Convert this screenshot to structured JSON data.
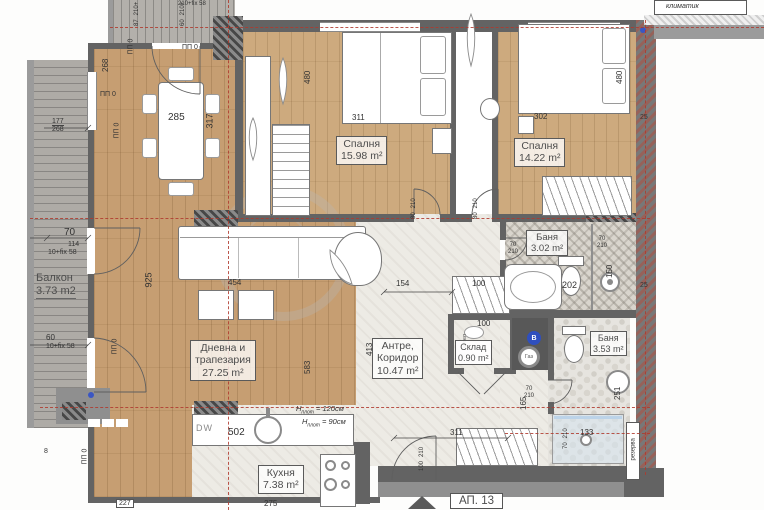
{
  "plan": {
    "apartment": "АП. 13",
    "ac_unit": "климатик",
    "reserve": "резерва",
    "boiler_tag": "котел"
  },
  "rooms": {
    "balcony": {
      "name": "Балкон",
      "area": "3.73 m2"
    },
    "living": {
      "line1": "Дневна и",
      "line2": "трапезария",
      "area": "27.25 m²"
    },
    "bedroom1": {
      "name": "Спалня",
      "area": "15.98 m²"
    },
    "bedroom2": {
      "name": "Спалня",
      "area": "14.22 m²"
    },
    "bath1": {
      "name": "Баня",
      "area": "3.02 m²"
    },
    "bath2": {
      "name": "Баня",
      "area": "3.53 m²"
    },
    "hall": {
      "line1": "Антре,",
      "line2": "Коридор",
      "area": "10.47 m²"
    },
    "storage": {
      "name": "Склад",
      "area": "0.90 m²"
    },
    "kitchen": {
      "name": "Кухня",
      "area": "7.38 m²"
    }
  },
  "dims": {
    "dining_width": "285",
    "dining_depth": "317",
    "balc_top_depth": "268",
    "frac_top": "177",
    "frac_bottom": "268",
    "left_win_70": "70",
    "left_win_114": "114",
    "left_fix_a": "10+fix 58",
    "left_win_60": "60",
    "left_fix_b": "10+fix 58",
    "left_door_8": "8",
    "living_height": "925",
    "sofa_span": "454",
    "living_span": "583",
    "hall_height": "413",
    "bed1_width": "311",
    "bed1_depth": "480",
    "bed2_width": "302",
    "bed2_depth": "480",
    "wall_25_a": "25",
    "wall_25_b": "25",
    "hall_width": "154",
    "ward_100": "100",
    "storage_100": "100",
    "bath1_202": "202",
    "bath1_150": "150",
    "hall_165": "165",
    "hall_311": "311",
    "sink_251": "251",
    "shower_133": "133",
    "sink_502": "502",
    "kitchen_275": "275",
    "kitchen_227": "227",
    "top_87": "87",
    "top_210p_a": "210+",
    "top_60": "60",
    "top_210p_b": "210+",
    "top_fix": "210+fix 58",
    "pp0": "ПП 0"
  },
  "doors": {
    "bed1": {
      "w": "80",
      "h": "210"
    },
    "bed2": {
      "w": "80",
      "h": "210"
    },
    "bath1": {
      "w": "70",
      "h": "210"
    },
    "bath1_shower": {
      "w": "70",
      "h": "210"
    },
    "bath2": {
      "w": "70",
      "h": "210"
    },
    "bath2_shower": {
      "w": "70",
      "h": "210"
    },
    "entrance": {
      "w": "100",
      "h": "210"
    }
  },
  "kitchen_notes": {
    "dw": "DW",
    "h": "H",
    "sub": "плот",
    "counter_high": " = 120см",
    "counter_low": " = 90см"
  },
  "appliances": {
    "water_heater": "В",
    "gas": "Газ"
  }
}
